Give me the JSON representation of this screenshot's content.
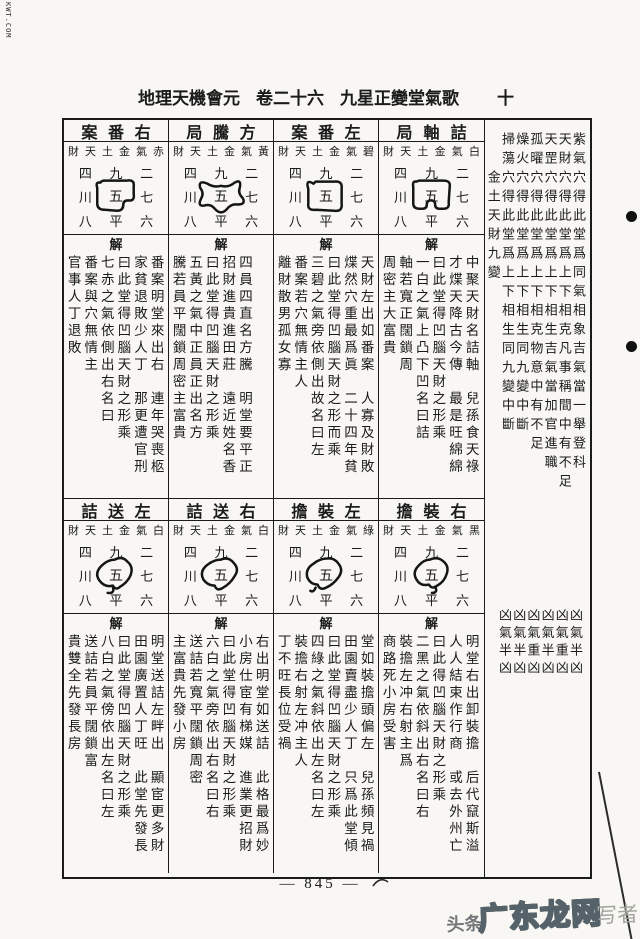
{
  "page": {
    "corner_mark": "KWT.COM",
    "title": {
      "work": "地理天機會元",
      "volume": "卷二十六",
      "chapter": "九星正變堂氣歌",
      "folio": "十"
    },
    "page_number": "— 845 —",
    "watermark": {
      "prefix": "头条",
      "brand": "广东龙网",
      "suffix": "写者"
    }
  },
  "square_chars": {
    "top": [
      "四",
      "九",
      "二"
    ],
    "mid": [
      "川",
      "五",
      "七"
    ],
    "bottom": [
      "八",
      "平",
      "六"
    ]
  },
  "jie_label": "解",
  "cells": [
    {
      "title": "案番右",
      "subtitle": "財天土金氣赤",
      "shape": "s1",
      "columns": [
        [
          "番案明堂來出右",
          "連年哭喪柩"
        ],
        [
          "家貧退敗少人丁",
          "那更遭官刑"
        ],
        [
          "曰此堂得凹腦天財之形乘"
        ],
        [
          "七赤之氣依側出右名曰"
        ],
        [
          "番案與穴無情主"
        ],
        [
          "官事人丁退敗"
        ]
      ]
    },
    {
      "title": "局騰方",
      "subtitle": "財天土金氣黃",
      "shape": "s2",
      "columns": [
        [
          "四員四直名方騰",
          "明堂要平正"
        ],
        [
          "招財進貴進田莊",
          "遠近姓名香"
        ],
        [
          "曰此堂得凹腦天財之形乘"
        ],
        [
          "五黃之氣中正員正出名方"
        ],
        [
          "騰若員平闊鎖周密主富貴"
        ]
      ]
    },
    {
      "title": "案番左",
      "subtitle": "財天土金氣碧",
      "shape": "s3",
      "columns": [
        [
          "天財左出如番案",
          "人寡及財敗"
        ],
        [
          "煠然穴重最爲眞",
          "二十四年貧"
        ],
        [
          "曰此堂得凹腦天財之形而乘"
        ],
        [
          "三碧之氣旁依側出故名曰左"
        ],
        [
          "番案若穴無情主人"
        ],
        [
          "離財散男孤女寡"
        ]
      ]
    },
    {
      "title": "局軸詰",
      "subtitle": "財天土金氣白",
      "shape": "s4",
      "columns": [
        [
          "中聚天財名詰軸",
          "兒孫食天祿"
        ],
        [
          "才煠天降古今傳",
          "最是旺綿綿"
        ],
        [
          "曰此堂得凹腦天財之形乘"
        ],
        [
          "一白之氣上凸下凹名曰詰"
        ],
        [
          "軸若寬正闊鎖周"
        ],
        [
          "周密主大富貴"
        ]
      ]
    },
    {
      "title": "詰送左",
      "subtitle": "財天土金氣白",
      "shape": "s5",
      "columns": [
        [
          "明堂送詰左畔出",
          "顯宦更多財"
        ],
        [
          "田園廣置人丁旺",
          "此堂先發長"
        ],
        [
          "曰此堂得凹腦天財之形乘"
        ],
        [
          "八白之氣傍依出左名曰左"
        ],
        [
          "送詰若員平闊鎖富"
        ],
        [
          "貴雙全先發長房"
        ]
      ]
    },
    {
      "title": "詰送右",
      "subtitle": "財天土金氣白",
      "shape": "s6",
      "columns": [
        [
          "右出明堂如送詰",
          "此格最爲妙"
        ],
        [
          "小房仕宦有梯媒",
          "進業更招財"
        ],
        [
          "曰此堂得凹腦天財之形乘"
        ],
        [
          "六白之氣旁依出右名曰右"
        ],
        [
          "送詰若寬平闊鎖周密"
        ],
        [
          "主富貴先發小房"
        ]
      ]
    },
    {
      "title": "擔裝左",
      "subtitle": "財天土金氣綠",
      "shape": "s7",
      "columns": [
        [
          "堂如裝擔頭偏左",
          "兒孫頻見禍"
        ],
        [
          "田園賣盡少人丁",
          "只爲此堂傾"
        ],
        [
          "曰此堂得凹腦天財之形乘"
        ],
        [
          "四綠之氣斜依出左名曰左"
        ],
        [
          "裝擔右射左冲主人"
        ],
        [
          "丁不旺長位受禍"
        ]
      ]
    },
    {
      "title": "擔裝右",
      "subtitle": "財天土金氣黑",
      "shape": "s8",
      "columns": [
        [
          "明堂右出卸裝擔",
          "后代竄斯溢"
        ],
        [
          "人人結束作行商",
          "或去外州亡"
        ],
        [
          "曰此得凹腦天財之形乘"
        ],
        [
          "二黑之氣依斜出右名曰右"
        ],
        [
          "裝擔左冲右射主爲"
        ],
        [
          "商路死小房受害"
        ]
      ]
    }
  ],
  "right_panel": {
    "columns": [
      {
        "text": "紫氣穴得此堂爲同氣相象吉氣當一舉登科",
        "offset": 0
      },
      {
        "text": "天財穴得此堂爲上下相克凡事稱間中有不足",
        "offset": 0
      },
      {
        "text": "天罡穴得此堂爲上下相生吉氣當加官進職",
        "offset": 0
      },
      {
        "text": "孤曜穴得此堂爲上下相克物意中有不足",
        "offset": 0
      },
      {
        "text": "燥火穴得此堂爲上下相生同九變中斷",
        "offset": 0
      },
      {
        "text": "掃蕩穴得此堂爲上下相生同九變中斷",
        "offset": 0
      },
      {
        "text": "金土天財九變",
        "offset": 2
      }
    ],
    "verdict_columns": [
      "凶氣半凶",
      "凶氣重凶",
      "凶氣半凶",
      "凶氣重凶",
      "凶氣半凶",
      "凶氣半凶"
    ]
  }
}
